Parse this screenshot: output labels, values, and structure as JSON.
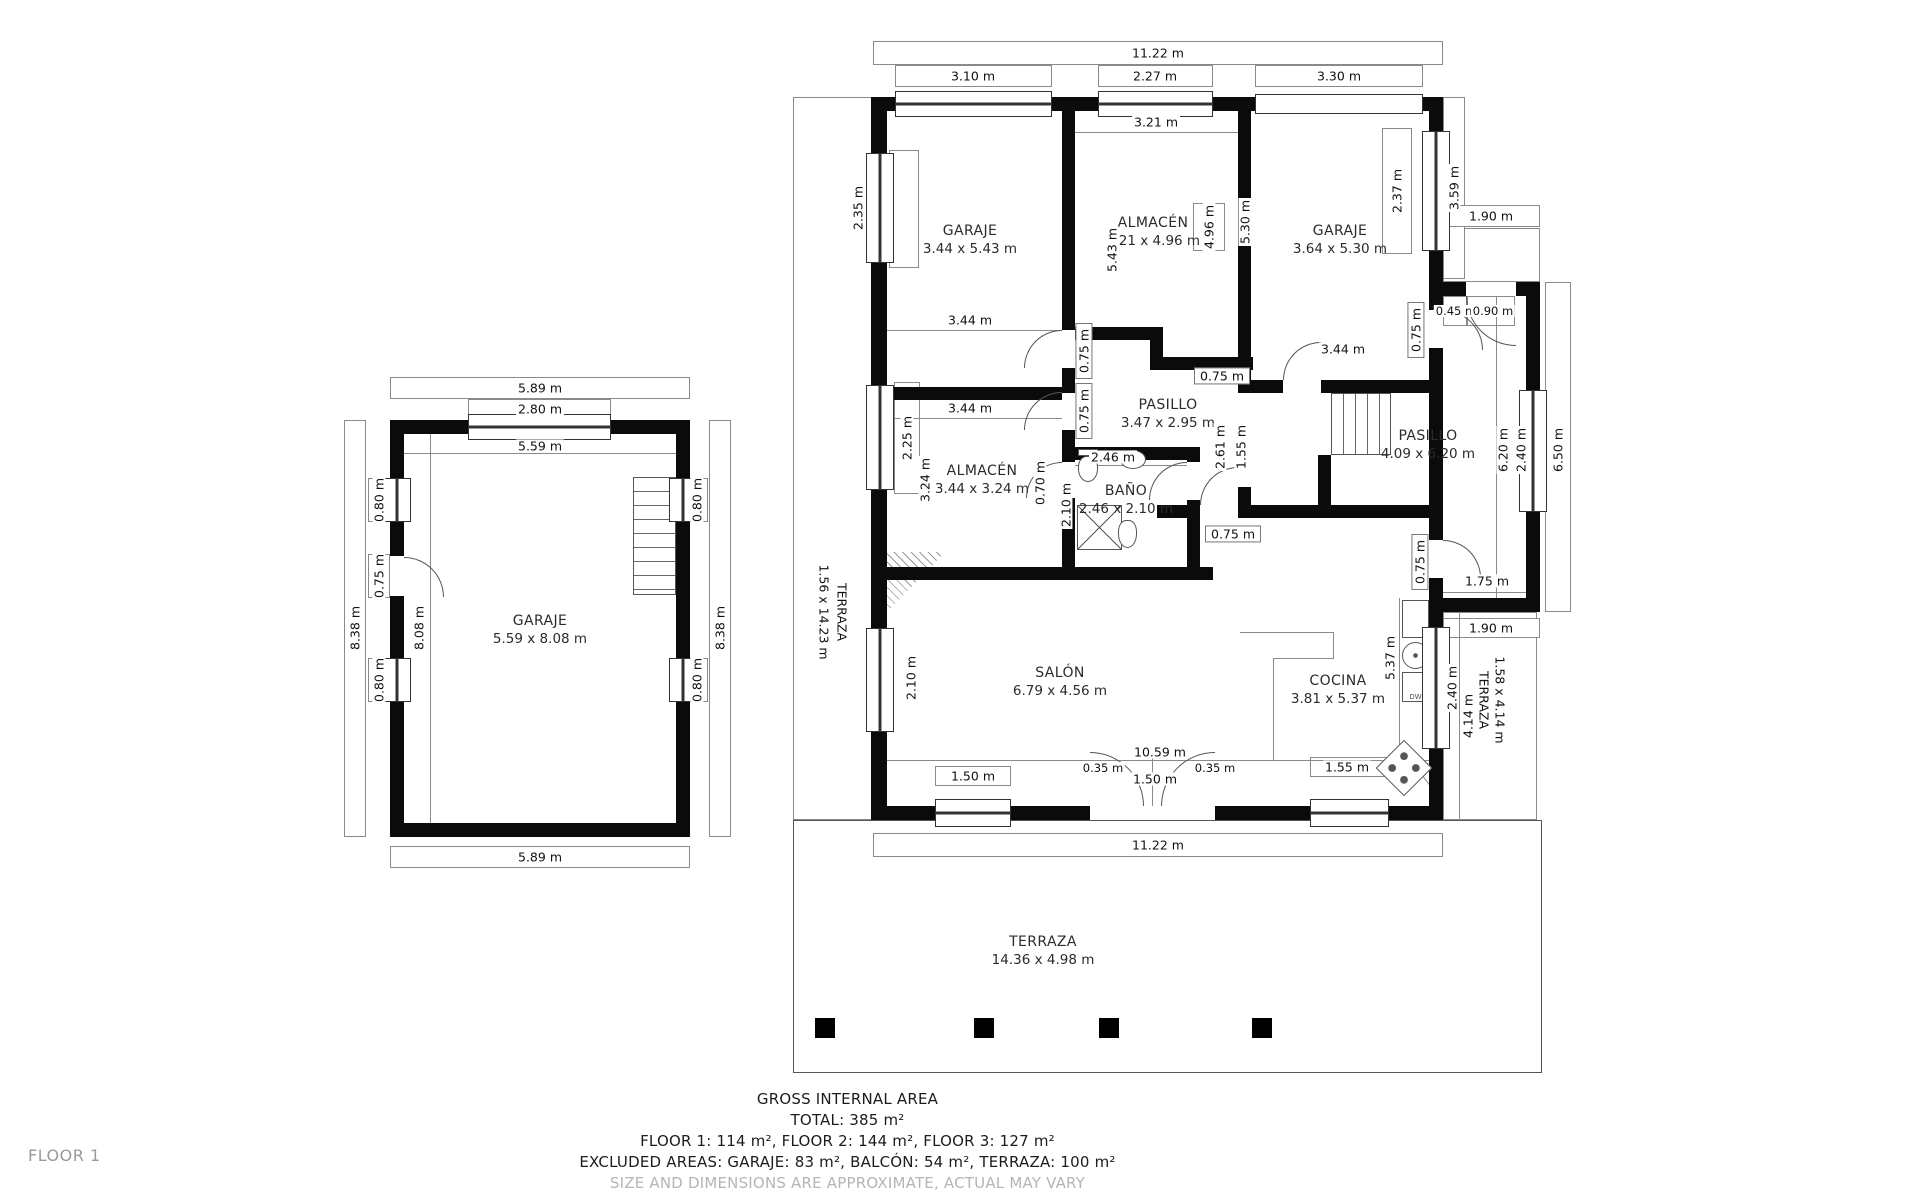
{
  "page": {
    "floor_label": "FLOOR 1"
  },
  "footer": {
    "title": "GROSS INTERNAL AREA",
    "total": "TOTAL: 385 m²",
    "floors": "FLOOR 1: 114 m², FLOOR 2: 144 m², FLOOR 3: 127 m²",
    "excluded": "EXCLUDED AREAS: GARAJE: 83 m², BALCÓN: 54 m², TERRAZA: 100 m²",
    "disclaimer": "SIZE AND DIMENSIONS ARE APPROXIMATE, ACTUAL MAY VARY"
  },
  "rooms": {
    "garaje1": {
      "name": "GARAJE",
      "dims": "3.44 x 5.43 m"
    },
    "almacen1": {
      "name": "ALMACÉN",
      "dims": "3.21 x 4.96 m"
    },
    "garaje2": {
      "name": "GARAJE",
      "dims": "3.64 x 5.30 m"
    },
    "pasillo1": {
      "name": "PASILLO",
      "dims": "3.47 x 2.95 m"
    },
    "almacen2": {
      "name": "ALMACÉN",
      "dims": "3.44 x 3.24 m"
    },
    "bano": {
      "name": "BAÑO",
      "dims": "2.46 x 2.10 m"
    },
    "pasillo2": {
      "name": "PASILLO",
      "dims": "4.09 x 6.20 m"
    },
    "salon": {
      "name": "SALÓN",
      "dims": "6.79 x 4.56 m"
    },
    "cocina": {
      "name": "COCINA",
      "dims": "3.81 x 5.37 m"
    },
    "garaje_big": {
      "name": "GARAJE",
      "dims": "5.59 x 8.08 m"
    },
    "terraza_left": {
      "name": "TERRAZA",
      "dims": "1.56 x 14.23 m"
    },
    "terraza_right": {
      "name": "TERRAZA",
      "dims": "1.58 x 4.14 m"
    },
    "terraza_bottom": {
      "name": "TERRAZA",
      "dims": "14.36 x 4.98 m"
    }
  },
  "d": {
    "m_top_total": "11.22 m",
    "m_top_g1": "3.10 m",
    "m_top_alm": "2.27 m",
    "m_top_g2": "3.30 m",
    "m_alm_w": "3.21 m",
    "m_win_235": "2.35 m",
    "m_win_225": "2.25 m",
    "m_win_210": "2.10 m",
    "m_g1_h": "5.43 m",
    "m_alm_h": "4.96 m",
    "m_g2_h": "5.30 m",
    "m_g2_win": "2.37 m",
    "m_g1_w": "3.44 m",
    "m_alm2_w": "3.44 m",
    "m_alm2_h": "3.24 m",
    "m_door_a": "0.75 m",
    "m_door_b": "0.75 m",
    "m_door_c": "0.75 m",
    "m_door_d": "0.75 m",
    "m_door_e": "0.70 m",
    "m_door_f": "0.75 m",
    "m_door_g": "0.75 m",
    "m_bano_w": "2.46 m",
    "m_bano_h": "2.10 m",
    "m_p1_a": "2.61 m",
    "m_p1_b": "1.55 m",
    "m_right_upper": "3.59 m",
    "m_entry_w": "1.90 m",
    "m_closet_a": "0.45 m",
    "m_closet_b": "0.90 m",
    "m_p2_h": "6.20 m",
    "m_p2_win": "2.40 m",
    "m_right_outer": "6.50 m",
    "m_passage": "1.75 m",
    "m_tz_r_w": "1.90 m",
    "m_tz_r_win": "2.40 m",
    "m_tz_r_h": "4.14 m",
    "m_cocina_h": "5.37 m",
    "m_bot_inner": "10.59 m",
    "m_bot_win1": "1.50 m",
    "m_bot_gap1": "0.35 m",
    "m_bot_door": "1.50 m",
    "m_bot_gap2": "0.35 m",
    "m_bot_win2": "1.55 m",
    "m_bot_total": "11.22 m",
    "g_top": "5.89 m",
    "g_top_win": "2.80 m",
    "g_top_in": "5.59 m",
    "g_left": "8.38 m",
    "g_left_in": "8.08 m",
    "g_win1": "0.80 m",
    "g_door": "0.75 m",
    "g_win2": "0.80 m",
    "g_right": "8.38 m",
    "g_win3": "0.80 m",
    "g_win4": "0.80 m",
    "g_bottom": "5.89 m"
  },
  "kitchen": {
    "dw": "DW"
  }
}
